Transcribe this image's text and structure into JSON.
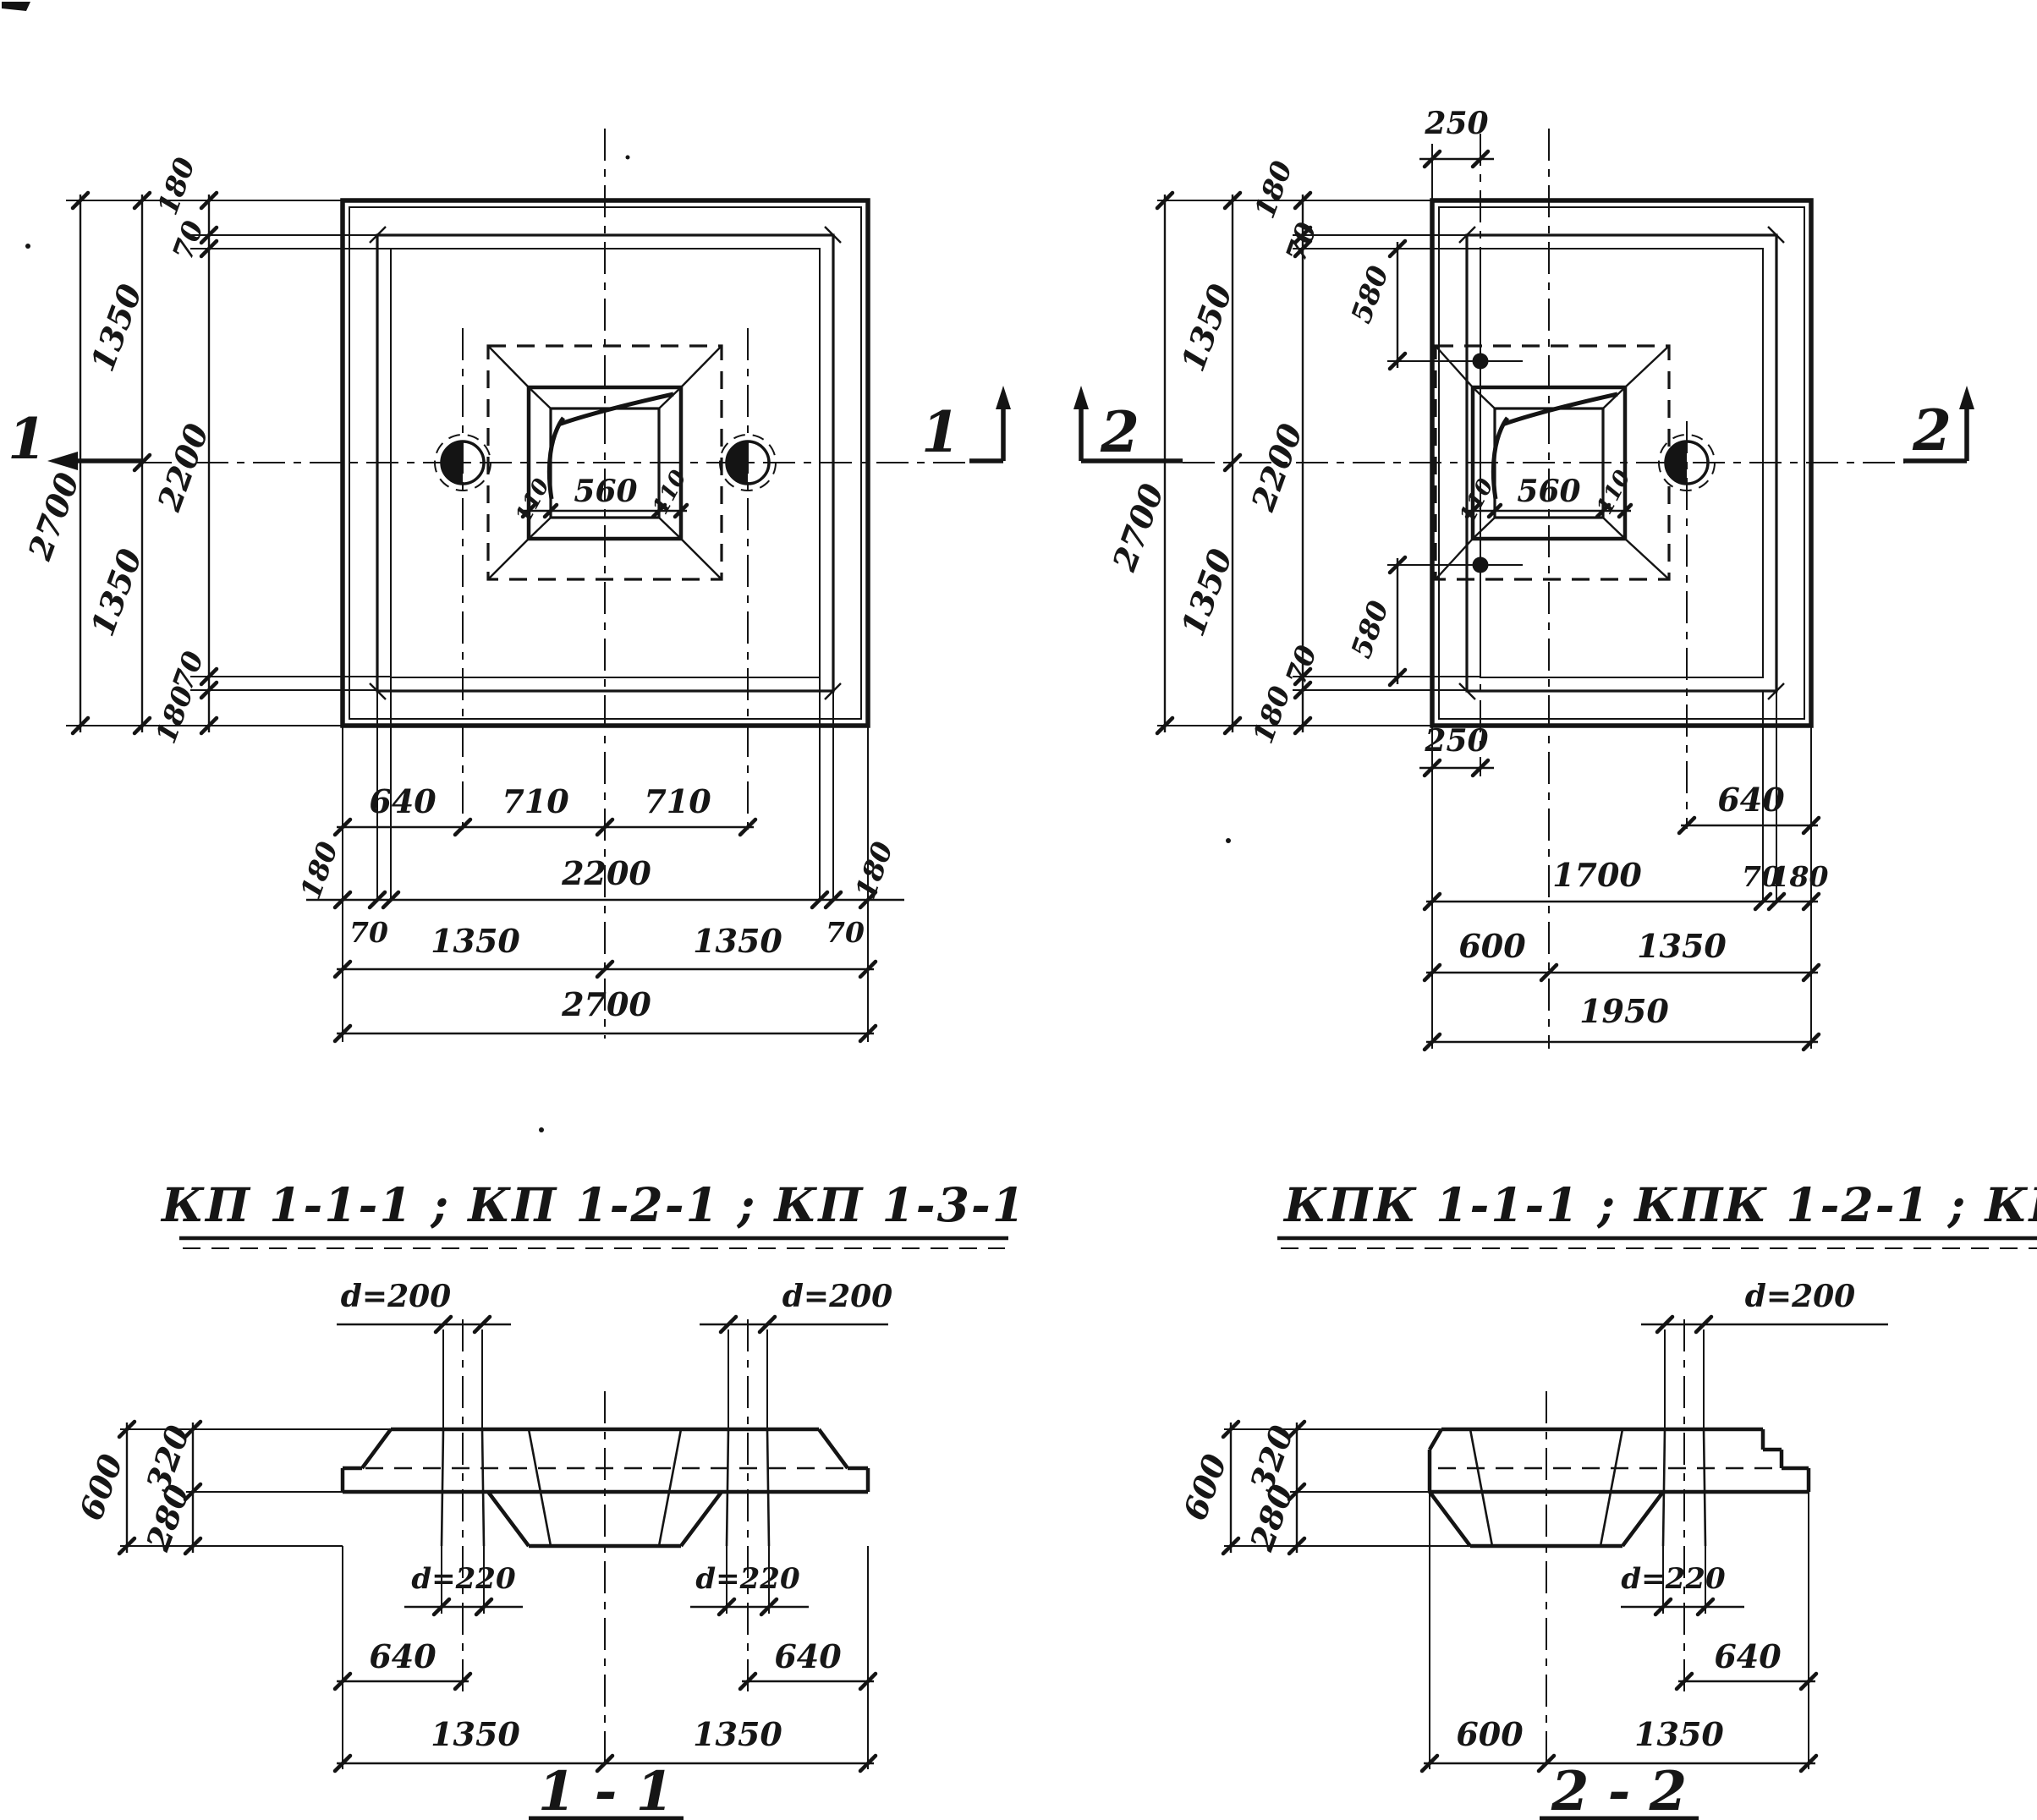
{
  "plan_left": {
    "marker_west": "1",
    "marker_east": "1",
    "v": {
      "total": "2700",
      "half_top": "1350",
      "half_bottom": "1350",
      "edge_top": "180",
      "step_top": "70",
      "inner": "2200",
      "step_bottom": "70",
      "edge_bottom": "180"
    },
    "h": {
      "hole_offset": "640",
      "hole_to_center_left": "710",
      "hole_to_center_right": "710",
      "edge_left": "180",
      "inner": "2200",
      "edge_right": "180",
      "step_left": "70",
      "half_left": "1350",
      "half_right": "1350",
      "step_right": "70",
      "total": "2700"
    },
    "pocket": {
      "left": "110",
      "width": "560",
      "right": "110"
    }
  },
  "plan_right": {
    "marker_west": "2",
    "marker_east": "2",
    "top_offset": "250",
    "bottom_offset": "250",
    "v": {
      "total": "2700",
      "half_top": "1350",
      "half_bottom": "1350",
      "edge_top": "180",
      "step_top": "70",
      "inner": "2200",
      "hole_top": "580",
      "hole_bottom": "580",
      "step_bottom": "70",
      "edge_bottom": "180"
    },
    "h": {
      "hole_offset": "640",
      "inner": "1700",
      "step": "70",
      "edge": "180",
      "column": "600",
      "half": "1350",
      "total": "1950"
    },
    "pocket": {
      "left": "110",
      "width": "560",
      "right": "110"
    }
  },
  "titles": {
    "left": "КП 1-1-1 ; КП 1-2-1 ; КП 1-3-1",
    "right": "КПК 1-1-1 ; КПК 1-2-1 ; КПК 1-3-1"
  },
  "section_1": {
    "title": "1 - 1",
    "d_top_left": "d=200",
    "d_top_right": "d=200",
    "height_total": "600",
    "height_top": "320",
    "height_bottom": "280",
    "d_bottom_left": "d=220",
    "d_bottom_right": "d=220",
    "hole_offset_left": "640",
    "hole_offset_right": "640",
    "half_left": "1350",
    "half_right": "1350"
  },
  "section_2": {
    "title": "2 - 2",
    "d_top": "d=200",
    "height_total": "600",
    "height_top": "320",
    "height_bottom": "280",
    "d_bottom": "d=220",
    "hole_offset": "640",
    "column": "600",
    "half": "1350"
  }
}
